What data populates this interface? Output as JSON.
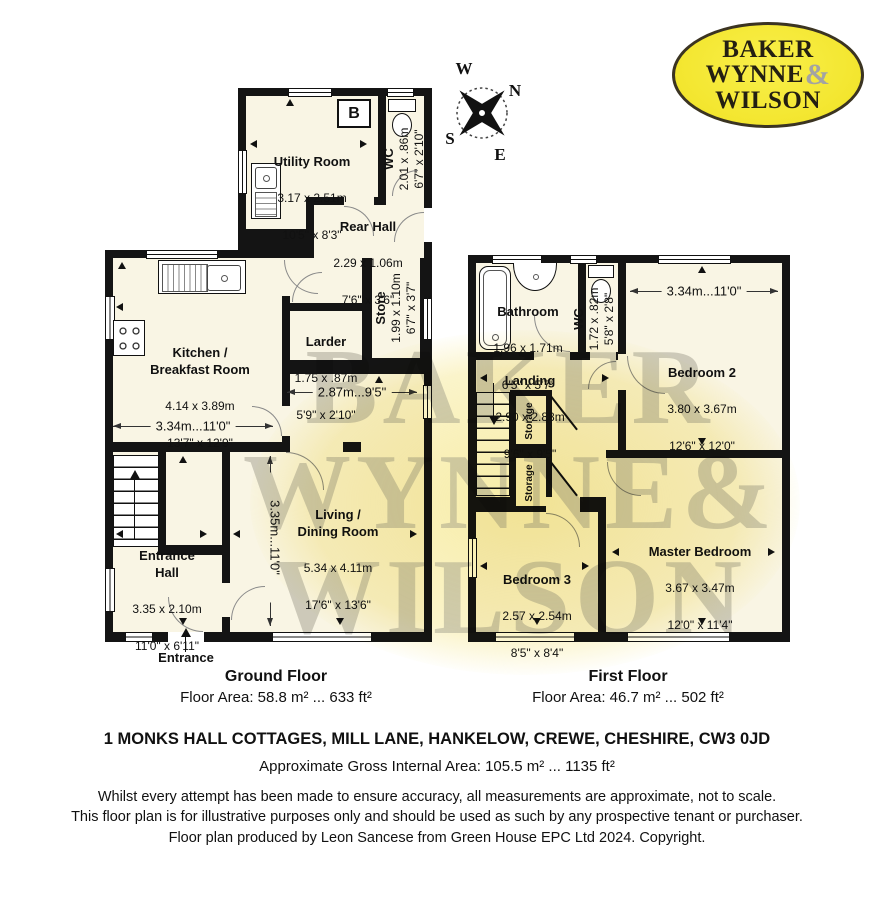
{
  "logo": {
    "line1": "BAKER",
    "line2": "WYNNE",
    "ampersand": "&",
    "line3": "WILSON"
  },
  "watermark": {
    "line1": "BAKER",
    "line2": "WYNNE",
    "ampersand": "&",
    "line3": "WILSON"
  },
  "compass": {
    "north": "N",
    "south": "S",
    "east": "E",
    "west": "W"
  },
  "ground_floor": {
    "title": "Ground Floor",
    "area_label": "Floor Area: 58.8 m² ... 633 ft²",
    "entrance_label": "Entrance",
    "boiler_label": "B",
    "rooms": [
      {
        "name": "Utility Room",
        "metric": "3.17 x 2.51m",
        "imperial": "10'5\" x 8'3\""
      },
      {
        "name": "WC",
        "metric": "2.01 x .86m",
        "imperial": "6'7\" x 2'10\""
      },
      {
        "name": "Rear Hall",
        "metric": "2.29 x 1.06m",
        "imperial": "7'6\" x 3'6\""
      },
      {
        "name": "Kitchen /\nBreakfast Room",
        "metric": "4.14 x 3.89m",
        "imperial": "13'7\" x 12'9\""
      },
      {
        "name": "Larder",
        "metric": "1.75 x .87m",
        "imperial": "5'9\" x 2'10\""
      },
      {
        "name": "Store",
        "metric": "1.99 x 1.10m",
        "imperial": "6'7\" x 3'7\""
      },
      {
        "name": "Living /\nDining Room",
        "metric": "5.34 x 4.11m",
        "imperial": "17'6\" x 13'6\""
      },
      {
        "name": "Entrance\nHall",
        "metric": "3.35 x 2.10m",
        "imperial": "11'0\" x 6'11\""
      }
    ],
    "dimensions": [
      {
        "label": "3.34m...11'0\""
      },
      {
        "label": "2.87m...9'5\""
      },
      {
        "label": "3.35m...11'0\""
      }
    ]
  },
  "first_floor": {
    "title": "First Floor",
    "area_label": "Floor Area: 46.7 m² ... 502 ft²",
    "rooms": [
      {
        "name": "Bathroom",
        "metric": "1.96 x 1.71m",
        "imperial": "6'5\" x 5'7\""
      },
      {
        "name": "WC",
        "metric": "1.72 x .82m",
        "imperial": "5'8\" x 2'8\""
      },
      {
        "name": "Bedroom 2",
        "metric": "3.80 x 3.67m",
        "imperial": "12'6\" x 12'0\""
      },
      {
        "name": "Landing",
        "metric": "2.90 x 2.88m",
        "imperial": "9'6\" x 9'5\""
      },
      {
        "name": "Storage"
      },
      {
        "name": "Storage"
      },
      {
        "name": "Bedroom 3",
        "metric": "2.57 x 2.54m",
        "imperial": "8'5\" x 8'4\""
      },
      {
        "name": "Master Bedroom",
        "metric": "3.67 x 3.47m",
        "imperial": "12'0\" x 11'4\""
      }
    ],
    "dimensions": [
      {
        "label": "3.34m...11'0\""
      }
    ]
  },
  "footer": {
    "address": "1 MONKS HALL COTTAGES, MILL LANE, HANKELOW, CREWE, CHESHIRE, CW3 0JD",
    "gross_area": "Approximate Gross Internal Area: 105.5 m² ... 1135 ft²",
    "disclaimer1": "Whilst every attempt has been made to ensure accuracy, all measurements are approximate, not to scale.",
    "disclaimer2": "This floor plan is for illustrative purposes only and should be used as such by any prospective tenant or purchaser.",
    "producer": "Floor plan produced by Leon Sancese from Green House EPC Ltd 2024. Copyright."
  }
}
